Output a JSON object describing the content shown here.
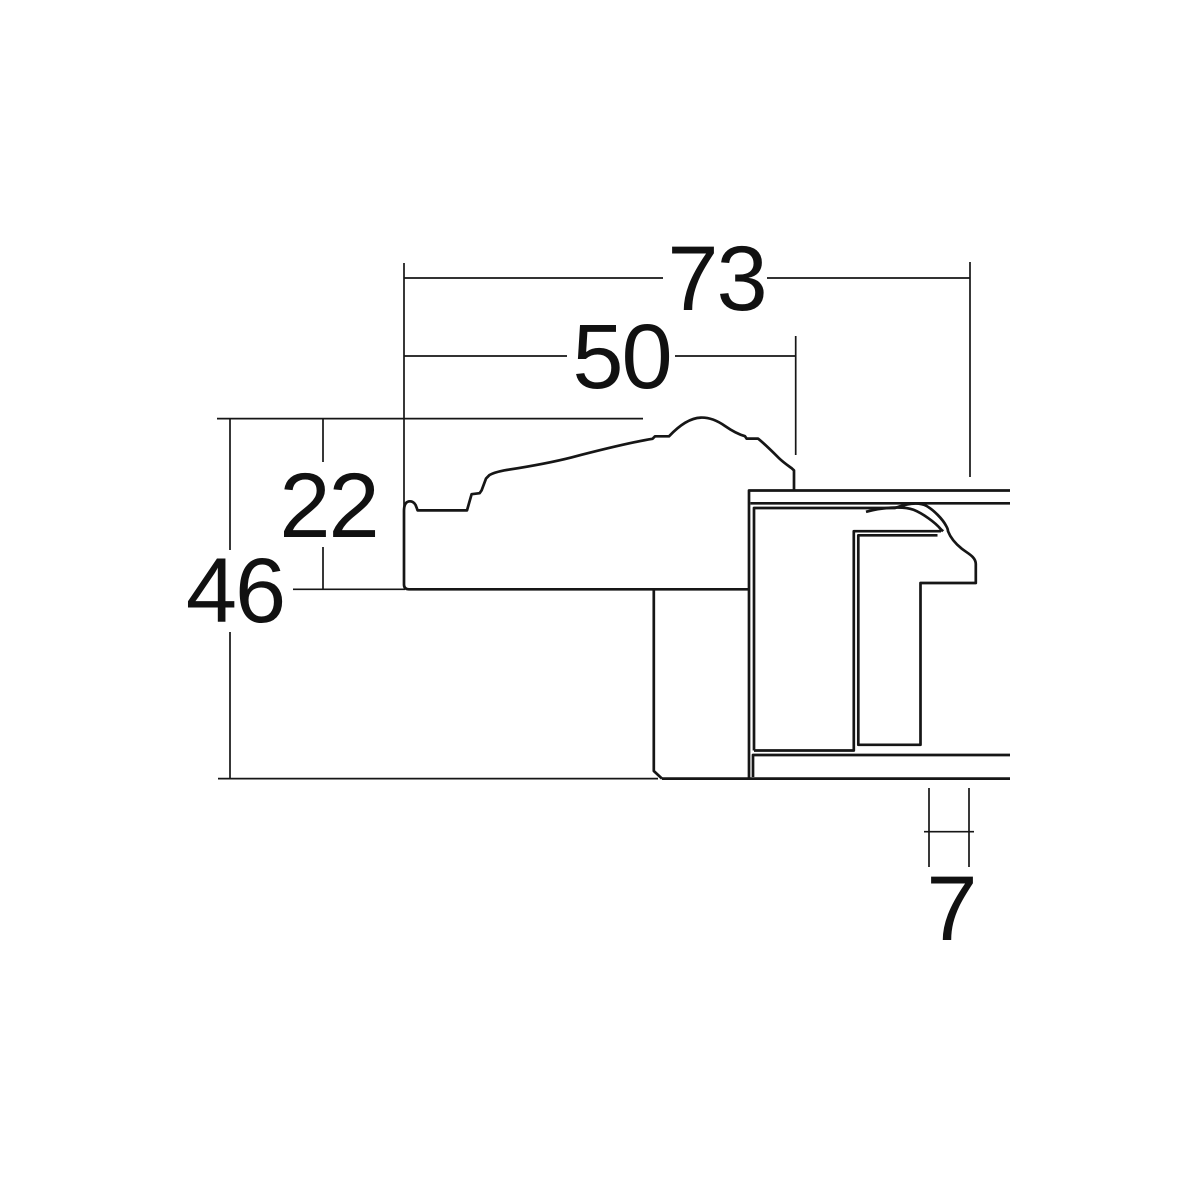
{
  "drawing": {
    "type": "technical-cross-section",
    "description": "Cross-section profile drawing of a picture frame moulding and its back channel, with linear dimensions",
    "background_color": "#ffffff",
    "line_color": "#161616",
    "dimension_labels": {
      "total_width": "73",
      "face_width": "50",
      "face_height": "22",
      "total_height": "46",
      "lip_depth": "7"
    }
  }
}
